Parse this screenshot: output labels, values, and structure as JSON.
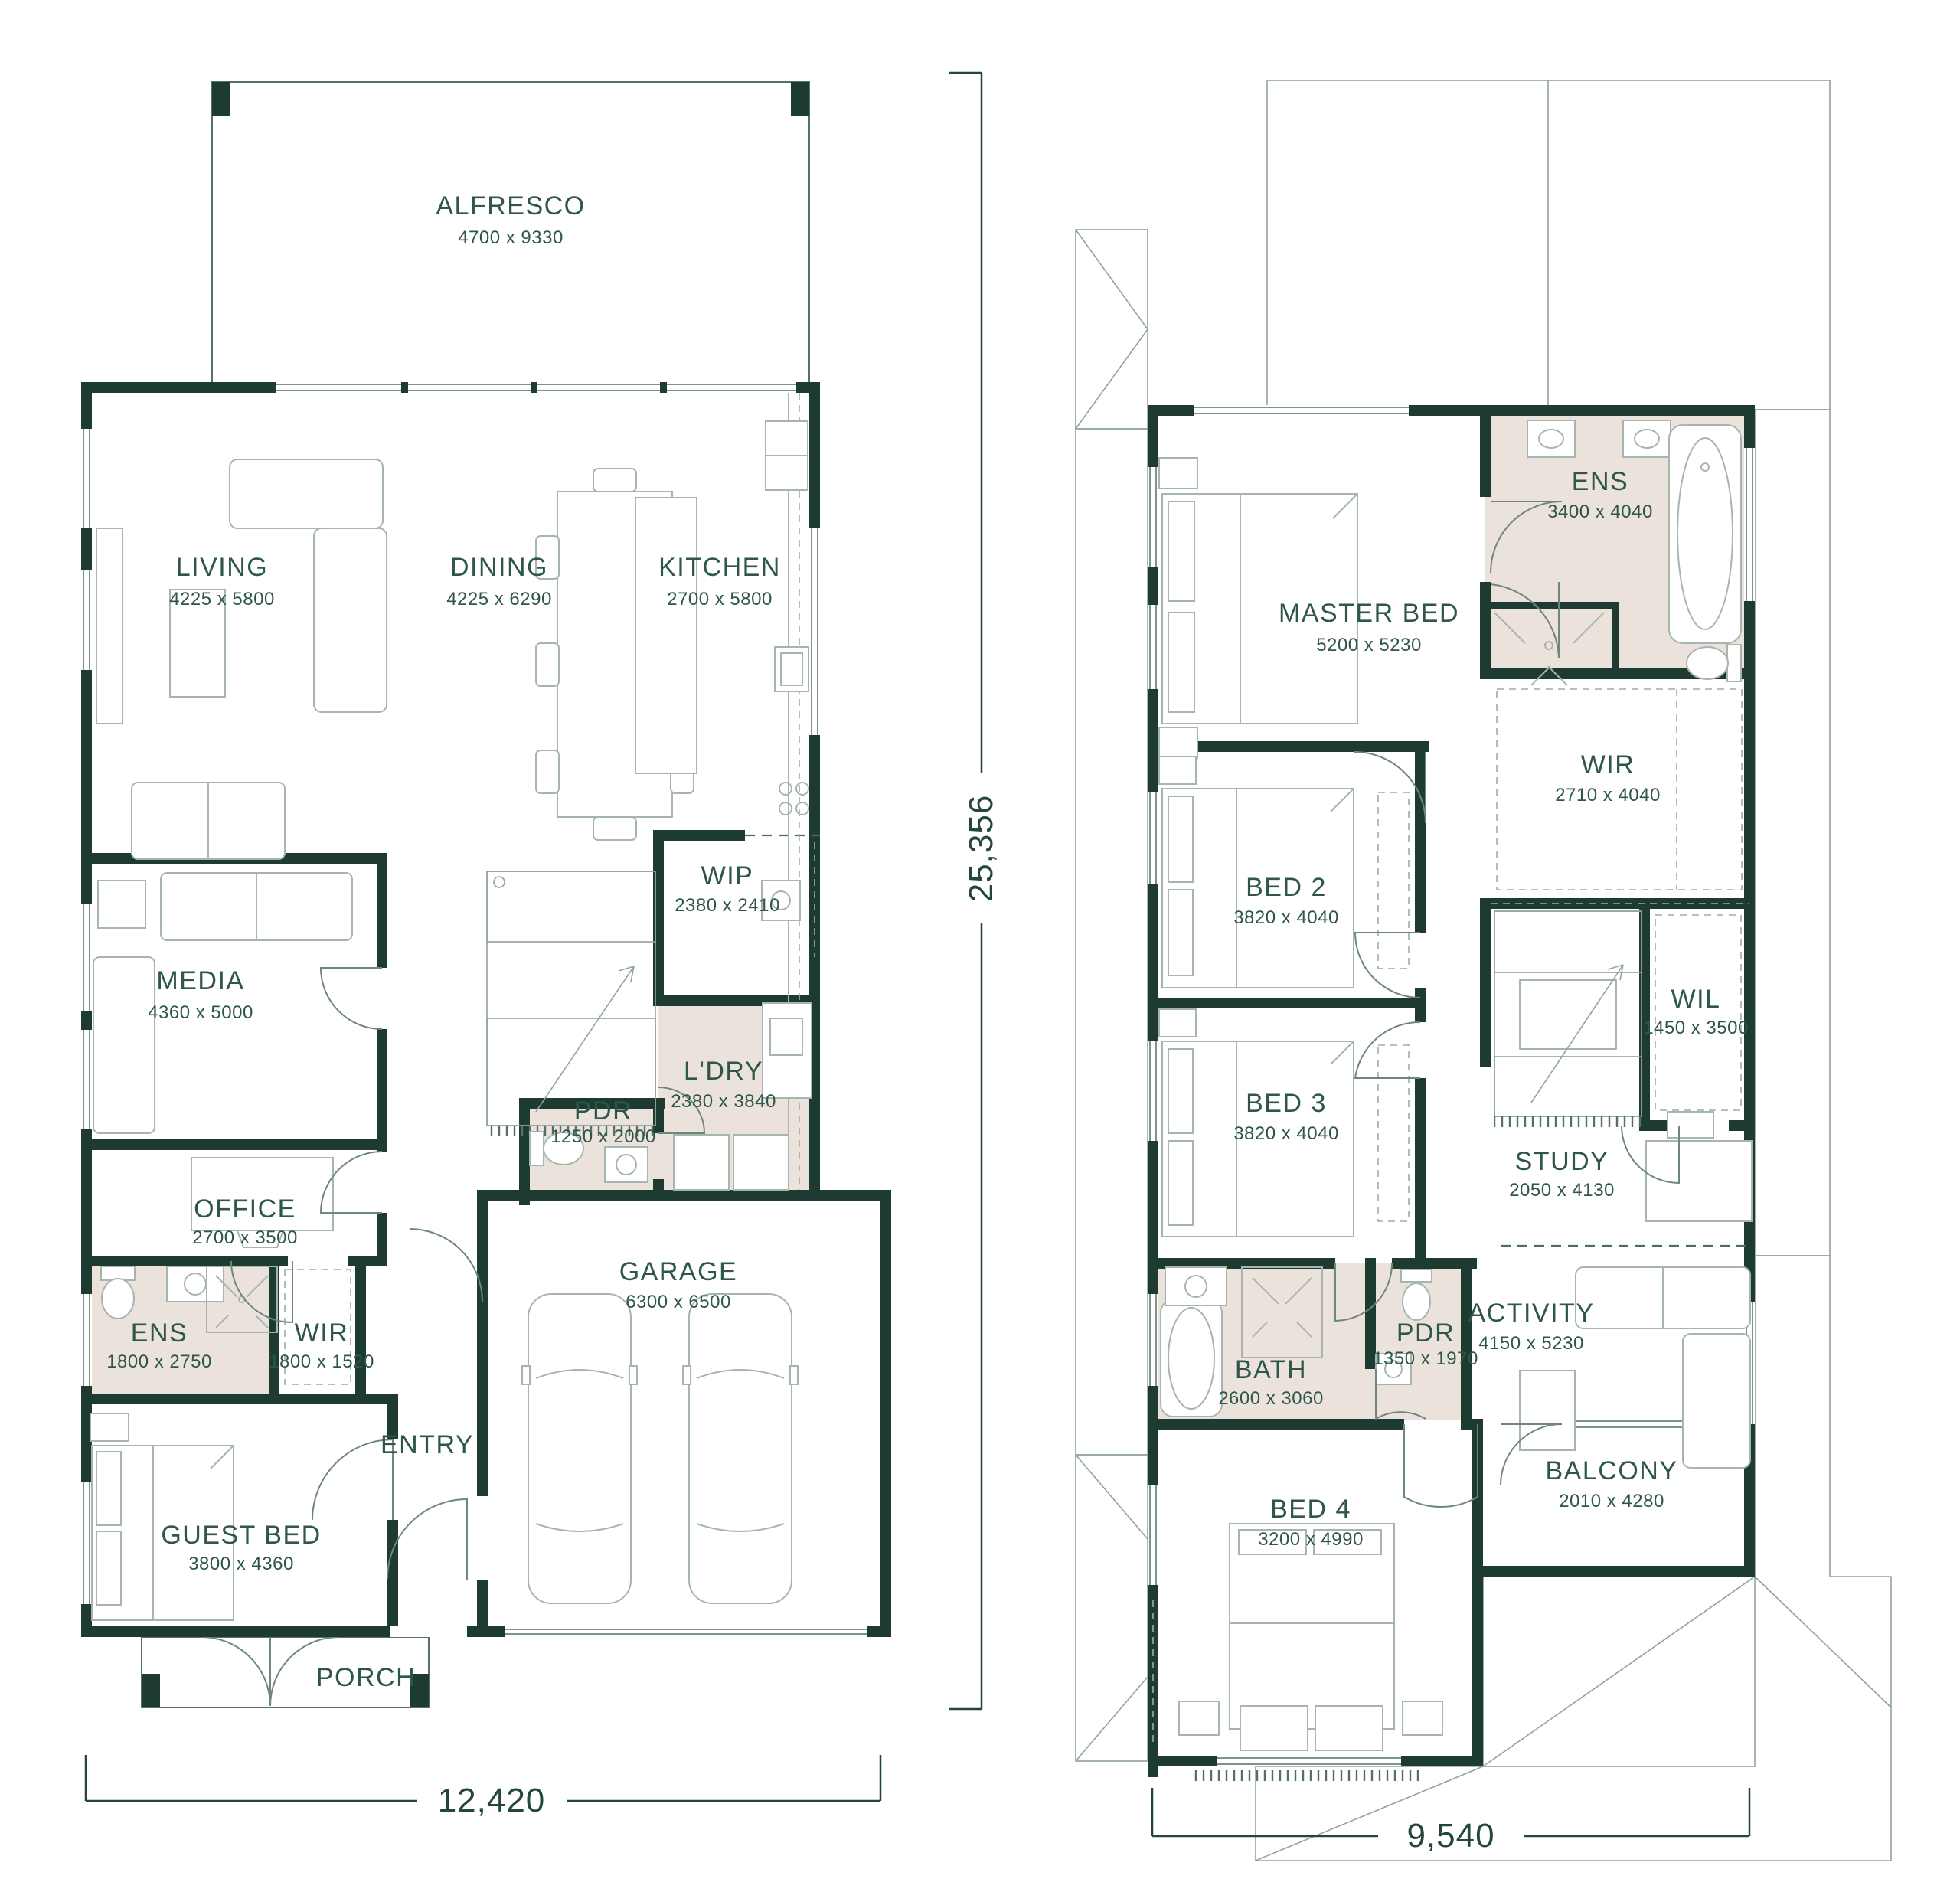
{
  "colors": {
    "wall": "#1e3b32",
    "label_text": "#2e564a",
    "wet_area_fill": "#ece2dc",
    "fixture_line": "#a6b6af",
    "roof_line": "#9aada4",
    "background": "#ffffff"
  },
  "ground_floor": {
    "rooms": [
      {
        "id": "alfresco",
        "label": "ALFRESCO",
        "dims": "4700 x 9330"
      },
      {
        "id": "living",
        "label": "LIVING",
        "dims": "4225 x 5800"
      },
      {
        "id": "dining",
        "label": "DINING",
        "dims": "4225 x 6290"
      },
      {
        "id": "kitchen",
        "label": "KITCHEN",
        "dims": "2700 x 5800"
      },
      {
        "id": "media",
        "label": "MEDIA",
        "dims": "4360 x 5000"
      },
      {
        "id": "wip",
        "label": "WIP",
        "dims": "2380 x 2410"
      },
      {
        "id": "ldry",
        "label": "L'DRY",
        "dims": "2380 x 3840"
      },
      {
        "id": "pdr",
        "label": "PDR",
        "dims": "1250 x 2000"
      },
      {
        "id": "office",
        "label": "OFFICE",
        "dims": "2700 x 3500"
      },
      {
        "id": "ens",
        "label": "ENS",
        "dims": "1800 x 2750"
      },
      {
        "id": "wir",
        "label": "WIR",
        "dims": "1800 x 1520"
      },
      {
        "id": "guest-bed",
        "label": "GUEST BED",
        "dims": "3800 x 4360"
      },
      {
        "id": "garage",
        "label": "GARAGE",
        "dims": "6300 x 6500"
      },
      {
        "id": "entry",
        "label": "ENTRY"
      },
      {
        "id": "porch",
        "label": "PORCH"
      }
    ],
    "width_dimension": "12,420",
    "height_dimension": "25,356"
  },
  "first_floor": {
    "rooms": [
      {
        "id": "master-bed",
        "label": "MASTER BED",
        "dims": "5200 x 5230"
      },
      {
        "id": "ens",
        "label": "ENS",
        "dims": "3400 x 4040"
      },
      {
        "id": "wir",
        "label": "WIR",
        "dims": "2710 x 4040"
      },
      {
        "id": "bed-2",
        "label": "BED 2",
        "dims": "3820 x 4040"
      },
      {
        "id": "wil",
        "label": "WIL",
        "dims": "1450 x 3500"
      },
      {
        "id": "bed-3",
        "label": "BED 3",
        "dims": "3820 x 4040"
      },
      {
        "id": "study",
        "label": "STUDY",
        "dims": "2050 x 4130"
      },
      {
        "id": "bath",
        "label": "BATH",
        "dims": "2600 x 3060"
      },
      {
        "id": "pdr",
        "label": "PDR",
        "dims": "1350 x 1970"
      },
      {
        "id": "activity",
        "label": "ACTIVITY",
        "dims": "4150 x 5230"
      },
      {
        "id": "bed-4",
        "label": "BED 4",
        "dims": "3200 x 4990"
      },
      {
        "id": "balcony",
        "label": "BALCONY",
        "dims": "2010 x 4280"
      }
    ],
    "width_dimension": "9,540"
  }
}
